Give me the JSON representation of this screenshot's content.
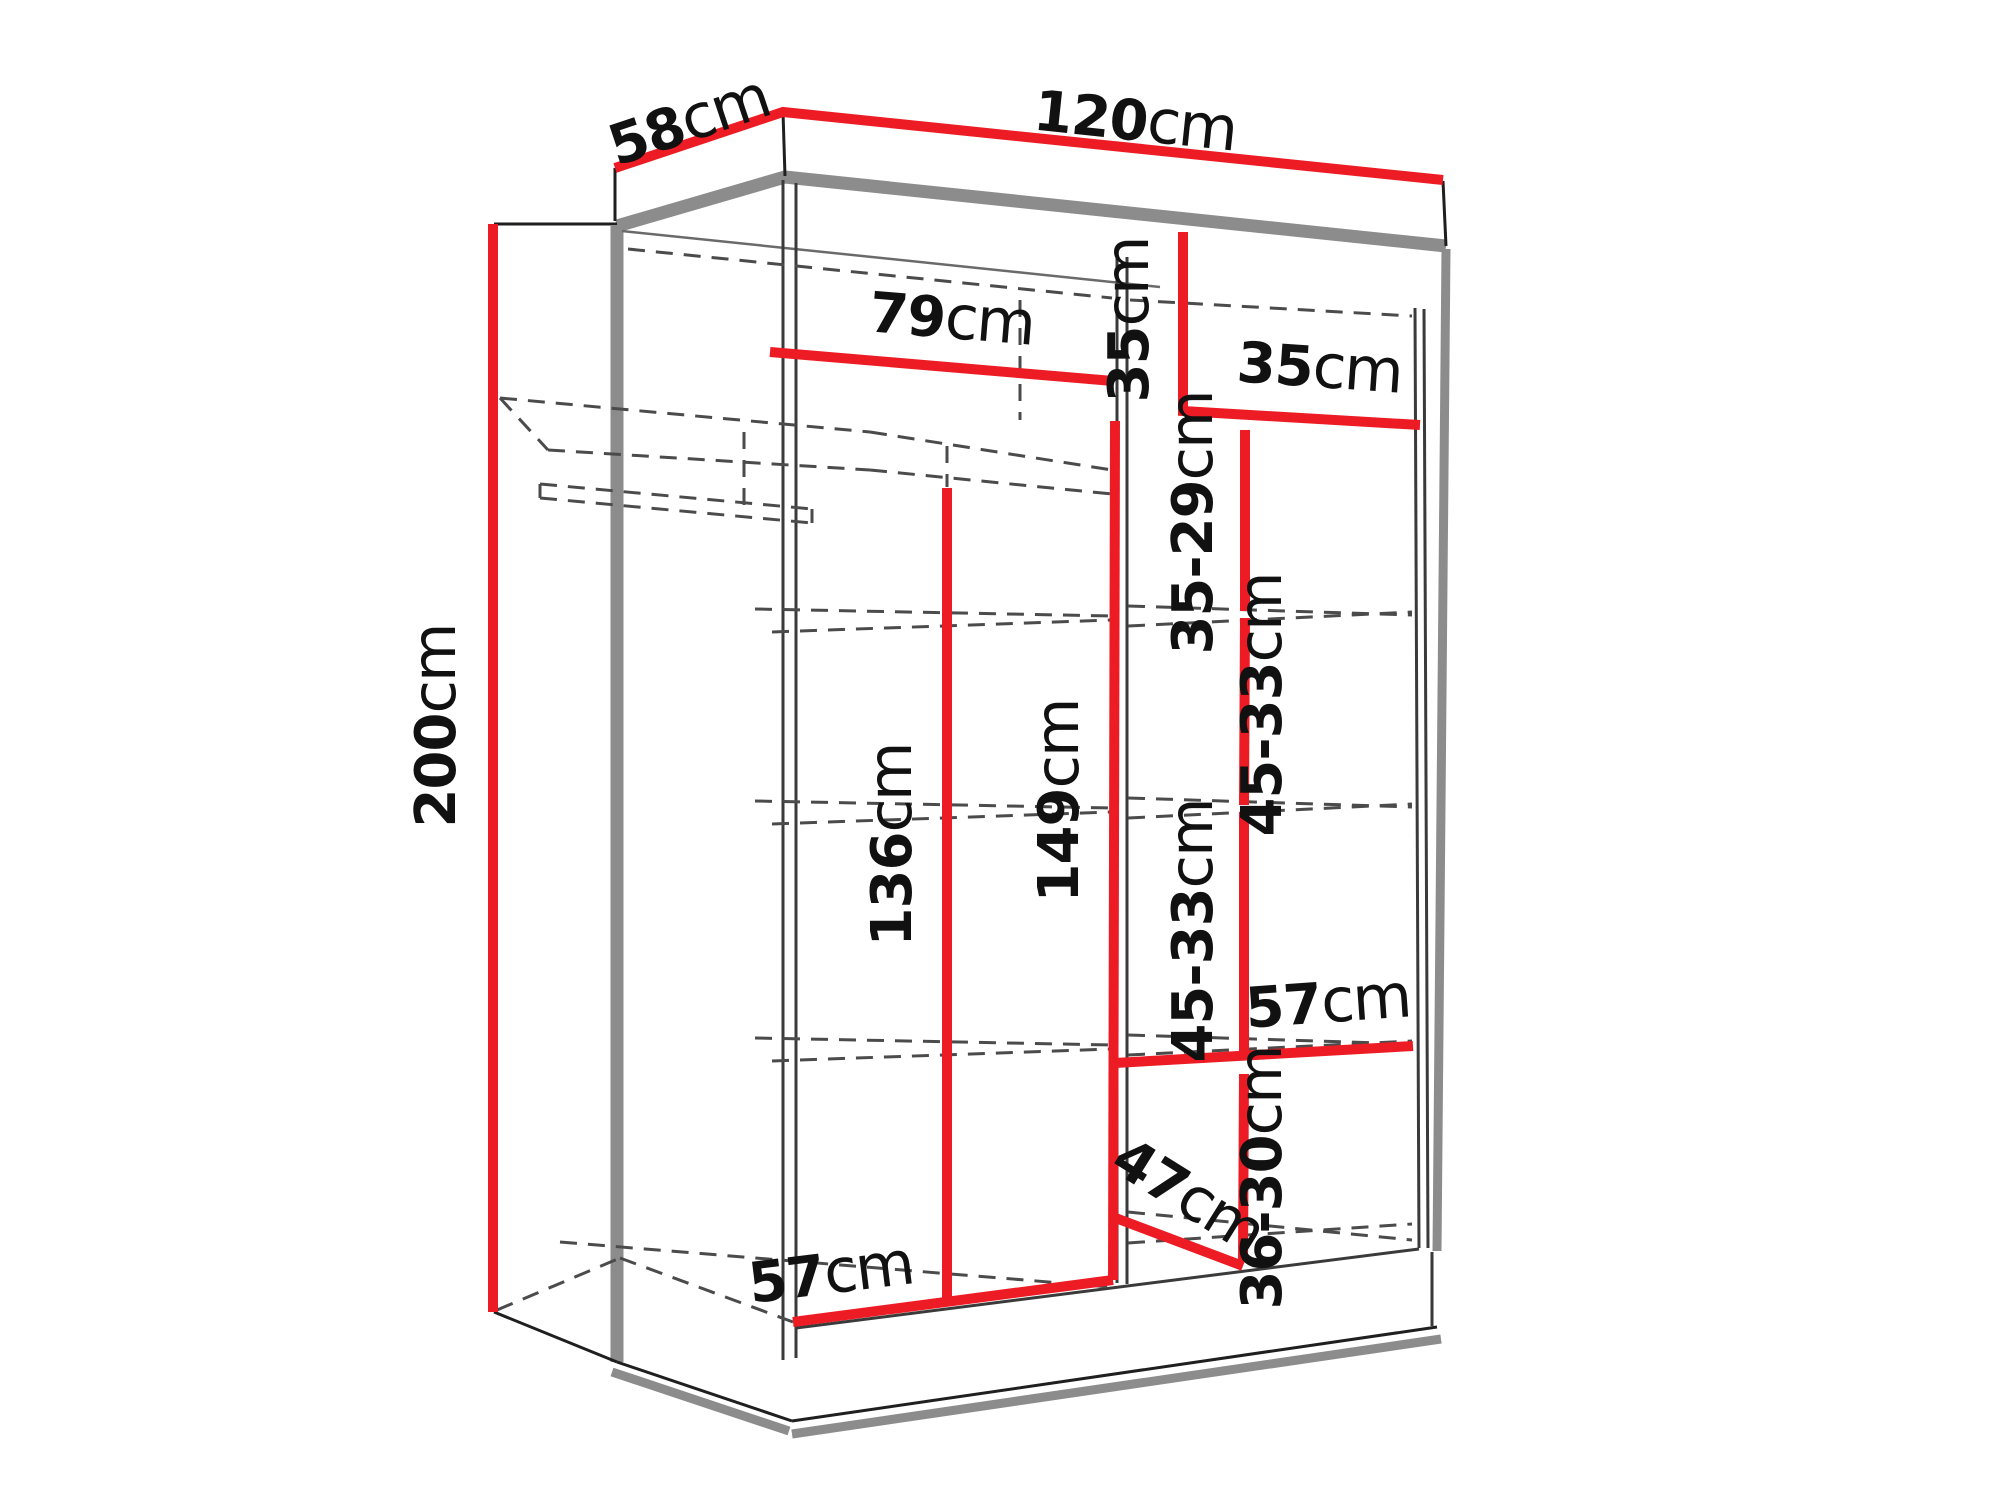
{
  "diagram": {
    "title": "wardrobe dimension drawing",
    "subject": "sliding-door wardrobe shown in 3D cutaway with interior measurements",
    "unit": "cm",
    "colors": {
      "dimension_line": "#ed1c24",
      "carcass_outline": "#8c8c8c",
      "text": "#111111",
      "background": "#ffffff"
    },
    "dimensions": {
      "depth": {
        "num": "58",
        "unit": "cm"
      },
      "width": {
        "num": "120",
        "unit": "cm"
      },
      "height": {
        "num": "200",
        "unit": "cm"
      },
      "left_section_width": {
        "num": "79",
        "unit": "cm"
      },
      "top_shelf_height": {
        "num": "35",
        "unit": "cm"
      },
      "right_section_width": {
        "num": "35",
        "unit": "cm"
      },
      "right_gap_1": {
        "num": "35-29",
        "unit": "cm"
      },
      "right_gap_2": {
        "num": "45-33",
        "unit": "cm"
      },
      "right_gap_3": {
        "num": "45-33",
        "unit": "cm"
      },
      "right_shelf_width": {
        "num": "57",
        "unit": "cm"
      },
      "right_gap_4": {
        "num": "36-30",
        "unit": "cm"
      },
      "divider_height": {
        "num": "149",
        "unit": "cm"
      },
      "hanging_height": {
        "num": "136",
        "unit": "cm"
      },
      "bottom_diagonal": {
        "num": "47",
        "unit": "cm"
      },
      "bottom_width": {
        "num": "57",
        "unit": "cm"
      }
    }
  }
}
